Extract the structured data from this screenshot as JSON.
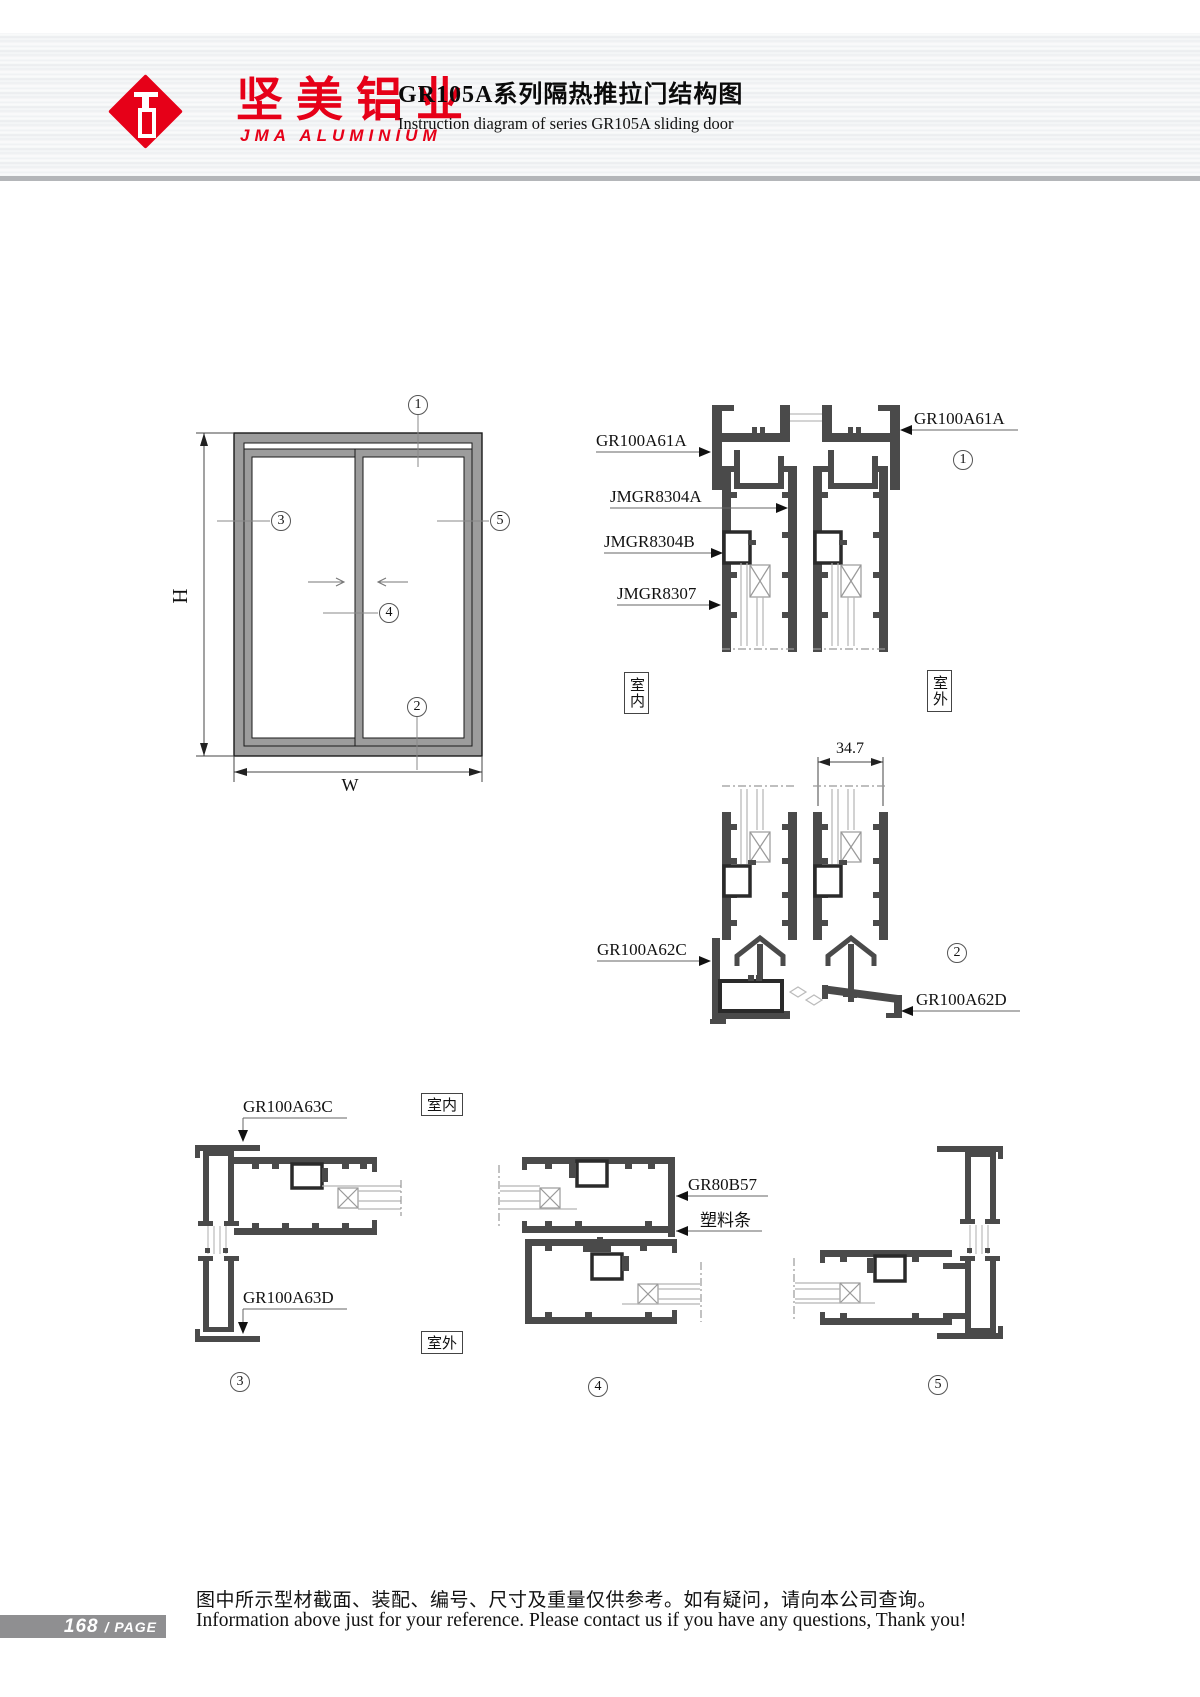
{
  "header": {
    "logo_cn": "坚美铝业",
    "logo_en": "JMA ALUMINIUM",
    "title_cn": "GR105A系列隔热推拉门结构图",
    "title_en": "Instruction diagram of series GR105A sliding door"
  },
  "elevation": {
    "h": "H",
    "w": "W"
  },
  "callouts": {
    "n1": "1",
    "n2": "2",
    "n3": "3",
    "n4": "4",
    "n5": "5"
  },
  "labels": {
    "gr100a61a": "GR100A61A",
    "jmgr8304a": "JMGR8304A",
    "jmgr8304b": "JMGR8304B",
    "jmgr8307": "JMGR8307",
    "dim347": "34.7",
    "gr100a62c": "GR100A62C",
    "gr100a62d": "GR100A62D",
    "gr100a63c": "GR100A63C",
    "gr100a63d": "GR100A63D",
    "gr80b57": "GR80B57",
    "plastic_strip": "塑料条",
    "indoor": "室内",
    "outdoor": "室外"
  },
  "footer": {
    "page_num": "168",
    "page_label": "/ PAGE",
    "note_cn": "图中所示型材截面、装配、编号、尺寸及重量仅供参考。如有疑问，请向本公司查询。",
    "note_en": "Information above just for your reference. Please contact us if you have any questions, Thank you!"
  }
}
